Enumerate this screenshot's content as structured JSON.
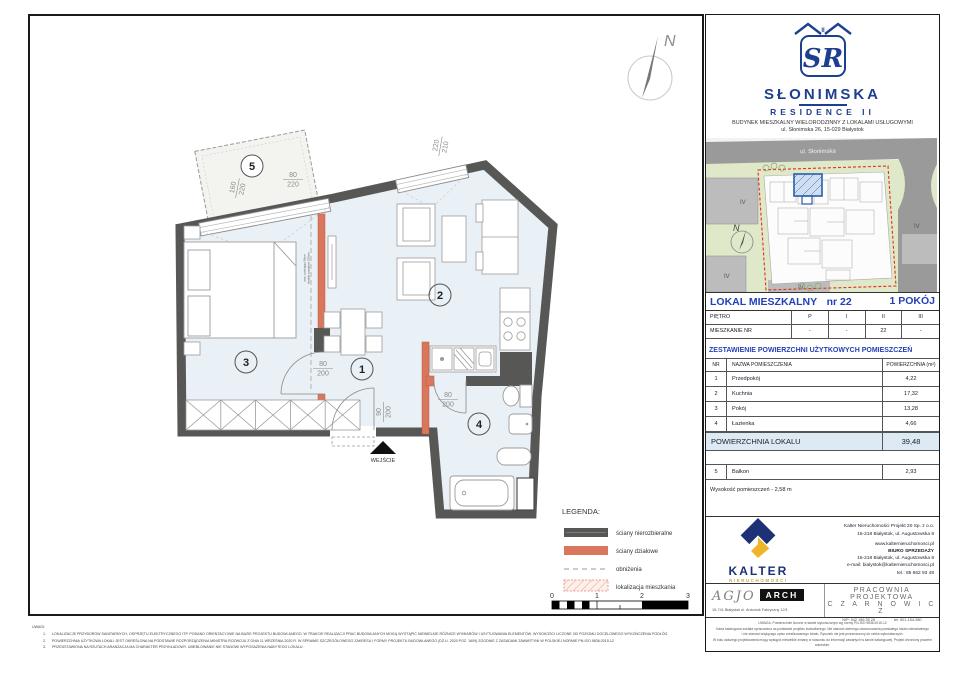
{
  "brand": {
    "monogram": "SR",
    "roman": "II",
    "name": "SŁONIMSKA",
    "sub": "RESIDENCE II",
    "desc": "BUDYNEK MIESZKALNY WIELORODZINNY Z LOKALAMI USŁUGOWYMI",
    "addr": "ul. Słonimska 26, 15-029 Białystok"
  },
  "site": {
    "street": "ul. Słonimska",
    "north": "N",
    "zone1": "IV",
    "zone2": "IV",
    "zone3": "IV",
    "zone4": "IV"
  },
  "unit": {
    "label": "LOKAL MIESZKALNY",
    "number": "nr 22",
    "rooms": "1 POKÓJ"
  },
  "floors": {
    "label": "PIĘTRO",
    "cols": [
      "P",
      "I",
      "II",
      "III"
    ],
    "row_label": "MIESZKANIE NR",
    "values": [
      "-",
      "-",
      "22",
      "-"
    ]
  },
  "areas": {
    "section_title": "ZESTAWIENIE POWIERZCHNI UŻYTKOWYCH POMIESZCZEŃ",
    "col_nr": "NR",
    "col_name": "NAZWA POMIESZCZENIA",
    "col_area": "POWIERZCHNIA (m²)",
    "rows": [
      {
        "nr": "1",
        "name": "Przedpokój",
        "area": "4,22"
      },
      {
        "nr": "2",
        "name": "Kuchnia",
        "area": "17,32"
      },
      {
        "nr": "3",
        "name": "Pokój",
        "area": "13,28"
      },
      {
        "nr": "4",
        "name": "Łazienka",
        "area": "4,66"
      }
    ],
    "total_label": "POWIERZCHNIA LOKALU",
    "total_value": "39,48",
    "balcony": {
      "nr": "5",
      "name": "Balkon",
      "area": "2,93"
    },
    "height_note": "Wysokość pomieszczeń - 2,58 m"
  },
  "plan": {
    "north": "N",
    "entrance": "WEJŚCIE",
    "rooms": {
      "r1": "1",
      "r2": "2",
      "r3": "3",
      "r4": "4",
      "r5": "5"
    },
    "dims": {
      "bal_win": {
        "t": "160",
        "b": "220"
      },
      "bal_door": {
        "t": "80",
        "b": "220"
      },
      "top_win": {
        "t": "220",
        "b": "210"
      },
      "door_room": {
        "t": "80",
        "b": "200"
      },
      "door_bath": {
        "t": "80",
        "b": "200"
      },
      "door_entry": {
        "t": "90",
        "b": "200"
      }
    },
    "annotation1": "wys. podciągu 28cm",
    "annotation2": "światło przejścia 230cm"
  },
  "legend": {
    "title": "LEGENDA:",
    "items": [
      {
        "label": "ściany nierozbieralne"
      },
      {
        "label": "ściany działowe"
      },
      {
        "label": "obniżenia"
      },
      {
        "label": "lokalizacja mieszkania"
      }
    ]
  },
  "scale_bar": {
    "labels": [
      "0",
      "1",
      "2",
      "3"
    ]
  },
  "developer": {
    "brand": "KALTER",
    "brand_sub": "NIERUCHOMOŚCI",
    "company": "Kalter Nieruchomości Projekt 20  Sp. z o.o.",
    "addr1": "15-218 Białystok, ul. Augustowska 8",
    "web": "www.kalternieruchomosci.pl",
    "office": "BIURO SPRZEDAŻY",
    "addr2": "15-218 Białystok, ul. Augustowska 8",
    "email": "e-mail: bialystok@kalternieruchomosci.pl",
    "phone": "tel.: 85 662 93 48"
  },
  "architect": {
    "agjo": "AGJO",
    "arch": "ARCH",
    "address": "15-741 Białystok    ul. Antoniuk Fabryczny    12/1",
    "studio1": "PRACOWNIA PROJEKTOWA",
    "studio2": "C Z A R N O W I C Z",
    "nip": "NIP:  542 186 35 28",
    "tel": "tel. 501-154-380"
  },
  "notes_left": {
    "title": "UWAGI:",
    "items": [
      "LOKALIZACJE PRZYBORÓW SANITARNYCH, OSPRZĘTU ELEKTRYCZNEGO ITP. PODANO ORIENTACYJNIE NA BAZIE PROJEKTU BUDOWLANEGO. W TRAKCIE REALIZACJI PRAC BUDOWLANYCH MOGĄ WYSTĄPIĆ NIEWIELKIE RÓŻNICE WYMIARÓW I USYTUOWANIA ELEMENTÓW. WYSOKOŚCI LICZONE OD POZIOMU DOCELOWEGO WYKOŃCZENIA PODŁÓG.",
      "POWIERZCHNIA UŻYTKOWA LOKALI JEST OKREŚLONA NA PODSTAWIE ROZPORZĄDZENIA MINISTRA ROZWOJU Z DNIA 11 WRZEŚNIA 2020 R. W SPRAWIE SZCZEGÓŁOWEGO ZAKRESU I FORMY PROJEKTU BUDOWLANEGO (DZ.U. 2020 POZ. 1609) ZGODNIE Z ZASADAMI ZAWARTYMI W POLSKIEJ NORMIE PN-ISO 9836:2015-12",
      "PRZEDSTAWIONA NA RZUTACH ARANŻACJA MA CHARAKTER PRZYKŁADOWY. UMEBLOWANIE NIE STANOWI WYPOSAŻENIA NABYTEGO LOKALU."
    ]
  },
  "notes_right": {
    "lines": [
      "UWAGA:  Powierzchnie liczone w stanie wykończonym wg normy PN-ISO 9836:2015-12",
      "Karta katalogowa została opracowana na podstawie projektu budowlanego. Nie stanowi wiernego odwzorowania powstałego lokalu mieszkalnego",
      "i nie stanowi wiążącego opisu zrealizowanego lokalu. Rysunek nie jest przeznaczony do celów wykonawczych.",
      "W toku dalszego projektowania mogą wystąpić niewielkie zmiany w stosunku do informacji zawartych w karcie katalogowej. Projekt chroniony prawem autorskim."
    ]
  }
}
